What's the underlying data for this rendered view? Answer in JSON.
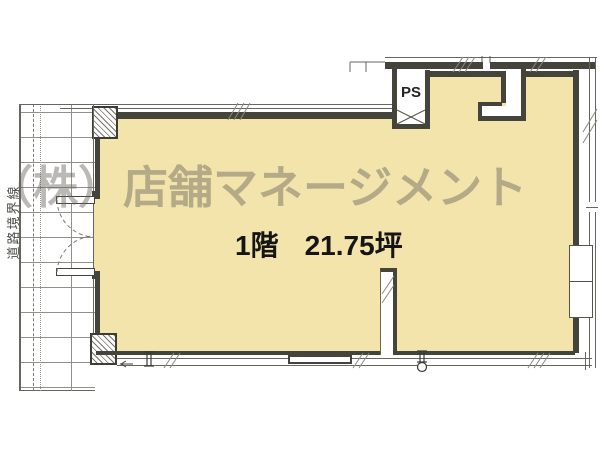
{
  "plan": {
    "watermark": "（株）店舗マネージメント",
    "floor_label": "1階",
    "area_label": "21.75坪",
    "ps_label": "PS",
    "road_boundary_label": "道路境界線",
    "colors": {
      "floor_fill": "#f2e4ab",
      "wall": "#45443a",
      "thin_line": "#66655f",
      "grid_line": "#908f89",
      "watermark_text": "rgba(104,99,90,0.45)",
      "label_text": "#151515"
    }
  }
}
